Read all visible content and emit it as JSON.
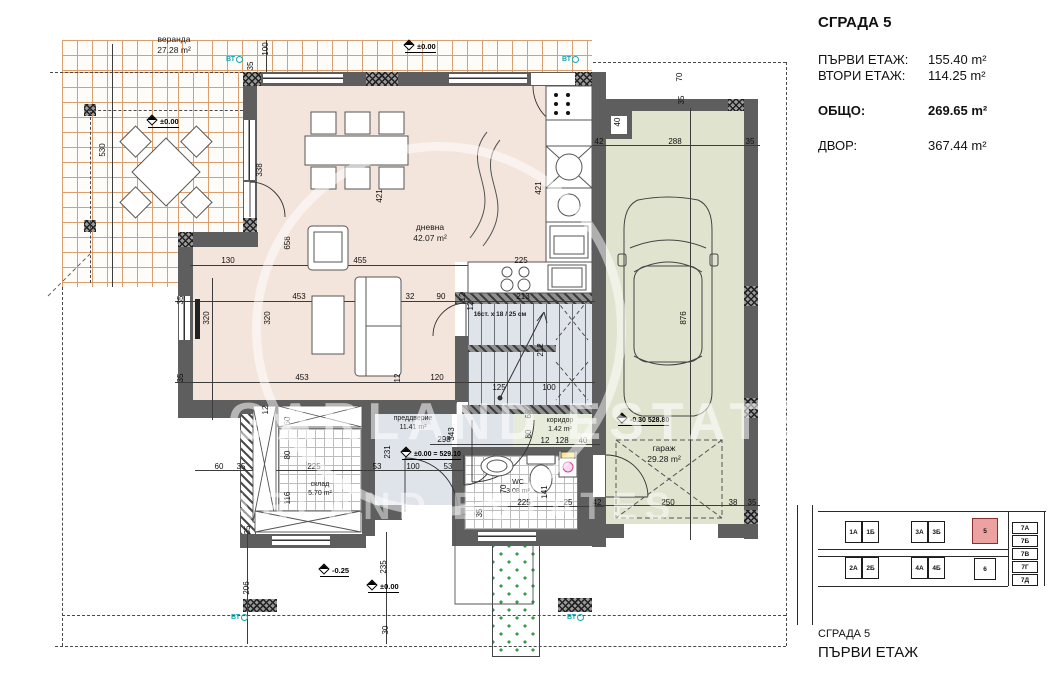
{
  "info": {
    "title": "СГРАДА 5",
    "rows": [
      {
        "label": "ПЪРВИ ЕТАЖ:",
        "value": "155.40 m²"
      },
      {
        "label": "ВТОРИ ЕТАЖ:",
        "value": "114.25 m²"
      },
      {
        "label": "ОБЩО:",
        "value": "269.65 m²"
      },
      {
        "label": "ДВОР:",
        "value": "367.44 m²"
      }
    ]
  },
  "plan": {
    "rooms": {
      "veranda": {
        "name": "веранда",
        "area": "27.28 m²"
      },
      "living": {
        "name": "дневна",
        "area": "42.07 m²"
      },
      "vestibule": {
        "name": "преддверие",
        "area": "11.41 m²"
      },
      "storage": {
        "name": "склад",
        "area": "5.70 m²"
      },
      "wc": {
        "name": "WC",
        "area": "3.08 m²"
      },
      "corridor": {
        "name": "коридор",
        "area": "1.42 m²"
      },
      "garage": {
        "name": "гараж",
        "area": "29.28 m²"
      }
    },
    "stairs_note": "16ст. x 18 / 25 см",
    "levels": {
      "zero": "±0.00",
      "zero_abs": "±0.00 = 529.10",
      "garage_abs": "-0.30  528.80",
      "minus": "-0.25",
      "vt": "ВТ"
    },
    "colors": {
      "wall": "#5e5e5e",
      "living_floor": "#f3e5dc",
      "stair_floor": "#dfe3ea",
      "garage_floor": "#e0e3ce",
      "corridor_floor": "#e7ebda",
      "veranda_grid": "#db9e6f",
      "teal": "#16a6b4",
      "highlight_building": "#eda2a2"
    }
  },
  "watermark": {
    "line1": "GARLAND ESTATES",
    "line2": "GARLAND ESTATES"
  },
  "dims": [
    {
      "t": "100",
      "x": 266,
      "y": 49,
      "v": 1
    },
    {
      "t": "35",
      "x": 251,
      "y": 66,
      "v": 1
    },
    {
      "t": "530",
      "x": 103,
      "y": 150,
      "v": 1
    },
    {
      "t": "338",
      "x": 260,
      "y": 170,
      "v": 1
    },
    {
      "t": "658",
      "x": 288,
      "y": 243,
      "v": 1
    },
    {
      "t": "421",
      "x": 380,
      "y": 196,
      "v": 1
    },
    {
      "t": "421",
      "x": 539,
      "y": 188,
      "v": 1
    },
    {
      "t": "130",
      "x": 228,
      "y": 261
    },
    {
      "t": "455",
      "x": 360,
      "y": 261
    },
    {
      "t": "225",
      "x": 521,
      "y": 261
    },
    {
      "t": "453",
      "x": 299,
      "y": 297
    },
    {
      "t": "453",
      "x": 302,
      "y": 378
    },
    {
      "t": "32",
      "x": 410,
      "y": 297
    },
    {
      "t": "90",
      "x": 441,
      "y": 297
    },
    {
      "t": "12",
      "x": 463,
      "y": 297,
      "v": 1
    },
    {
      "t": "213",
      "x": 523,
      "y": 297
    },
    {
      "t": "320",
      "x": 207,
      "y": 318,
      "v": 1
    },
    {
      "t": "320",
      "x": 268,
      "y": 318,
      "v": 1
    },
    {
      "t": "35",
      "x": 181,
      "y": 300,
      "v": 1
    },
    {
      "t": "35",
      "x": 181,
      "y": 378,
      "v": 1
    },
    {
      "t": "12",
      "x": 398,
      "y": 378,
      "v": 1
    },
    {
      "t": "120",
      "x": 437,
      "y": 378
    },
    {
      "t": "125",
      "x": 499,
      "y": 388
    },
    {
      "t": "100",
      "x": 549,
      "y": 388
    },
    {
      "t": "212",
      "x": 541,
      "y": 350,
      "v": 1
    },
    {
      "t": "343",
      "x": 452,
      "y": 434,
      "v": 1
    },
    {
      "t": "298",
      "x": 444,
      "y": 440
    },
    {
      "t": "231",
      "x": 388,
      "y": 452,
      "v": 1
    },
    {
      "t": "12",
      "x": 266,
      "y": 410,
      "v": 1
    },
    {
      "t": "60",
      "x": 288,
      "y": 421,
      "v": 1
    },
    {
      "t": "80",
      "x": 288,
      "y": 455,
      "v": 1
    },
    {
      "t": "116",
      "x": 288,
      "y": 498,
      "v": 1
    },
    {
      "t": "60",
      "x": 219,
      "y": 467
    },
    {
      "t": "35",
      "x": 241,
      "y": 467
    },
    {
      "t": "225",
      "x": 314,
      "y": 467
    },
    {
      "t": "53",
      "x": 377,
      "y": 467
    },
    {
      "t": "100",
      "x": 413,
      "y": 467
    },
    {
      "t": "53",
      "x": 448,
      "y": 467
    },
    {
      "t": "65",
      "x": 529,
      "y": 414,
      "v": 1
    },
    {
      "t": "80",
      "x": 529,
      "y": 434,
      "v": 1
    },
    {
      "t": "12",
      "x": 545,
      "y": 441
    },
    {
      "t": "128",
      "x": 562,
      "y": 441
    },
    {
      "t": "40",
      "x": 583,
      "y": 441
    },
    {
      "t": "70",
      "x": 504,
      "y": 489,
      "v": 1
    },
    {
      "t": "141",
      "x": 545,
      "y": 492,
      "v": 1
    },
    {
      "t": "225",
      "x": 524,
      "y": 503
    },
    {
      "t": "25",
      "x": 568,
      "y": 503
    },
    {
      "t": "35",
      "x": 480,
      "y": 513,
      "v": 1
    },
    {
      "t": "35",
      "x": 248,
      "y": 530,
      "v": 1
    },
    {
      "t": "206",
      "x": 247,
      "y": 588,
      "v": 1
    },
    {
      "t": "235",
      "x": 384,
      "y": 567,
      "v": 1
    },
    {
      "t": "30",
      "x": 386,
      "y": 630,
      "v": 1
    },
    {
      "t": "70",
      "x": 680,
      "y": 77,
      "v": 1
    },
    {
      "t": "35",
      "x": 682,
      "y": 100,
      "v": 1
    },
    {
      "t": "40",
      "x": 618,
      "y": 122,
      "v": 1
    },
    {
      "t": "42",
      "x": 599,
      "y": 142
    },
    {
      "t": "288",
      "x": 675,
      "y": 142
    },
    {
      "t": "35",
      "x": 750,
      "y": 142
    },
    {
      "t": "876",
      "x": 684,
      "y": 318,
      "v": 1
    },
    {
      "t": "42",
      "x": 597,
      "y": 503
    },
    {
      "t": "250",
      "x": 668,
      "y": 503
    },
    {
      "t": "38",
      "x": 733,
      "y": 503
    },
    {
      "t": "35",
      "x": 752,
      "y": 503
    },
    {
      "t": "12",
      "x": 471,
      "y": 306,
      "v": 1
    }
  ],
  "siteplan": {
    "caption_building": "СГРАДА 5",
    "caption_floor": "ПЪРВИ ЕТАЖ",
    "buildings": [
      {
        "label": "1А",
        "x": 845,
        "y": 521,
        "w": 17,
        "h": 22
      },
      {
        "label": "1Б",
        "x": 862,
        "y": 521,
        "w": 17,
        "h": 22
      },
      {
        "label": "3А",
        "x": 911,
        "y": 521,
        "w": 17,
        "h": 22
      },
      {
        "label": "3Б",
        "x": 928,
        "y": 521,
        "w": 17,
        "h": 22
      },
      {
        "label": "5",
        "x": 972,
        "y": 518,
        "w": 26,
        "h": 26,
        "hl": true
      },
      {
        "label": "2А",
        "x": 845,
        "y": 557,
        "w": 17,
        "h": 22
      },
      {
        "label": "2Б",
        "x": 862,
        "y": 557,
        "w": 17,
        "h": 22
      },
      {
        "label": "4А",
        "x": 911,
        "y": 557,
        "w": 17,
        "h": 22
      },
      {
        "label": "4Б",
        "x": 928,
        "y": 557,
        "w": 17,
        "h": 22
      },
      {
        "label": "6",
        "x": 974,
        "y": 558,
        "w": 22,
        "h": 22
      },
      {
        "label": "7А",
        "x": 1012,
        "y": 522,
        "w": 26,
        "h": 12
      },
      {
        "label": "7Б",
        "x": 1012,
        "y": 535,
        "w": 26,
        "h": 12
      },
      {
        "label": "7В",
        "x": 1012,
        "y": 548,
        "w": 26,
        "h": 12
      },
      {
        "label": "7Г",
        "x": 1012,
        "y": 561,
        "w": 26,
        "h": 12
      },
      {
        "label": "7Д",
        "x": 1012,
        "y": 574,
        "w": 26,
        "h": 12
      }
    ]
  }
}
